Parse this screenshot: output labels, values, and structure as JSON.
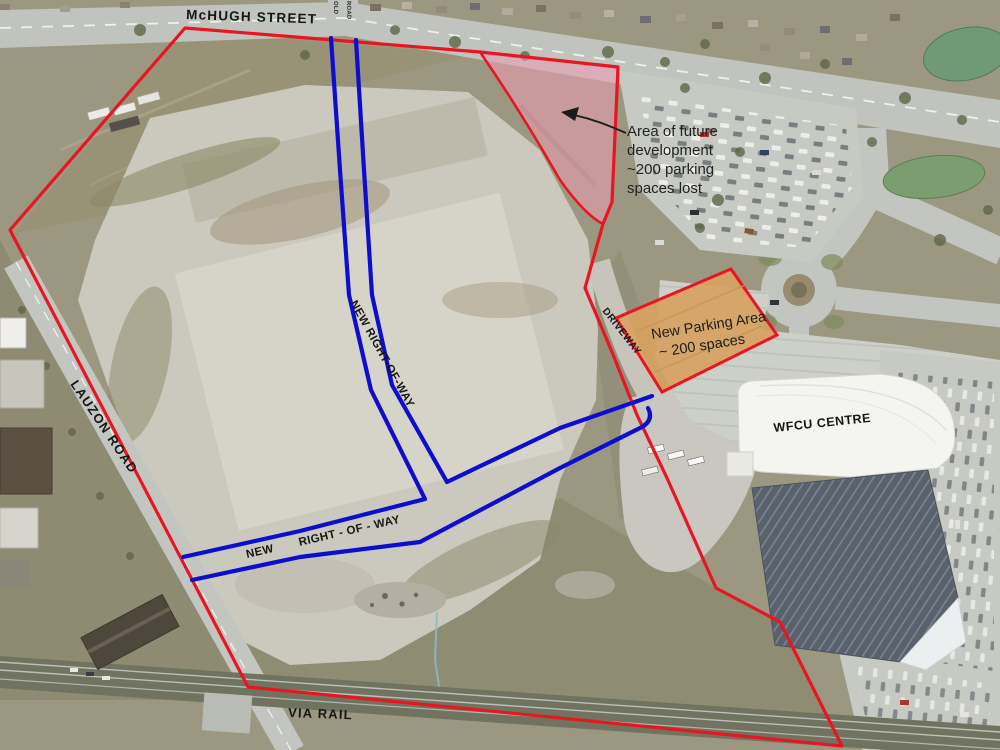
{
  "map_title": "Aerial site plan",
  "labels": {
    "mchugh_street": "McHUGH STREET",
    "old_road_word1": "OLD",
    "old_road_word2": "ROAD",
    "lauzon_road": "LAUZON ROAD",
    "via_rail": "VIA RAIL",
    "wfcu_centre": "WFCU CENTRE",
    "driveway": "DRIVEWAY",
    "new_row_vertical": "NEW RIGHT-OF-WAY",
    "new_row_h_word1": "NEW",
    "new_row_h_word2": "RIGHT - OF - WAY"
  },
  "annotations": {
    "future_development": {
      "lines": [
        "Area of future",
        "development",
        "~200 parking",
        "spaces lost"
      ]
    },
    "new_parking_area": {
      "line1": "New Parking Area",
      "line2": "~ 200 spaces"
    }
  },
  "colors": {
    "boundary_red": "#e81523",
    "right_of_way_blue": "#0d0dd0",
    "future_area_pink": "#ef9db2",
    "new_parking_orange": "#d7a261",
    "annotation_black": "#1b1b1b"
  }
}
